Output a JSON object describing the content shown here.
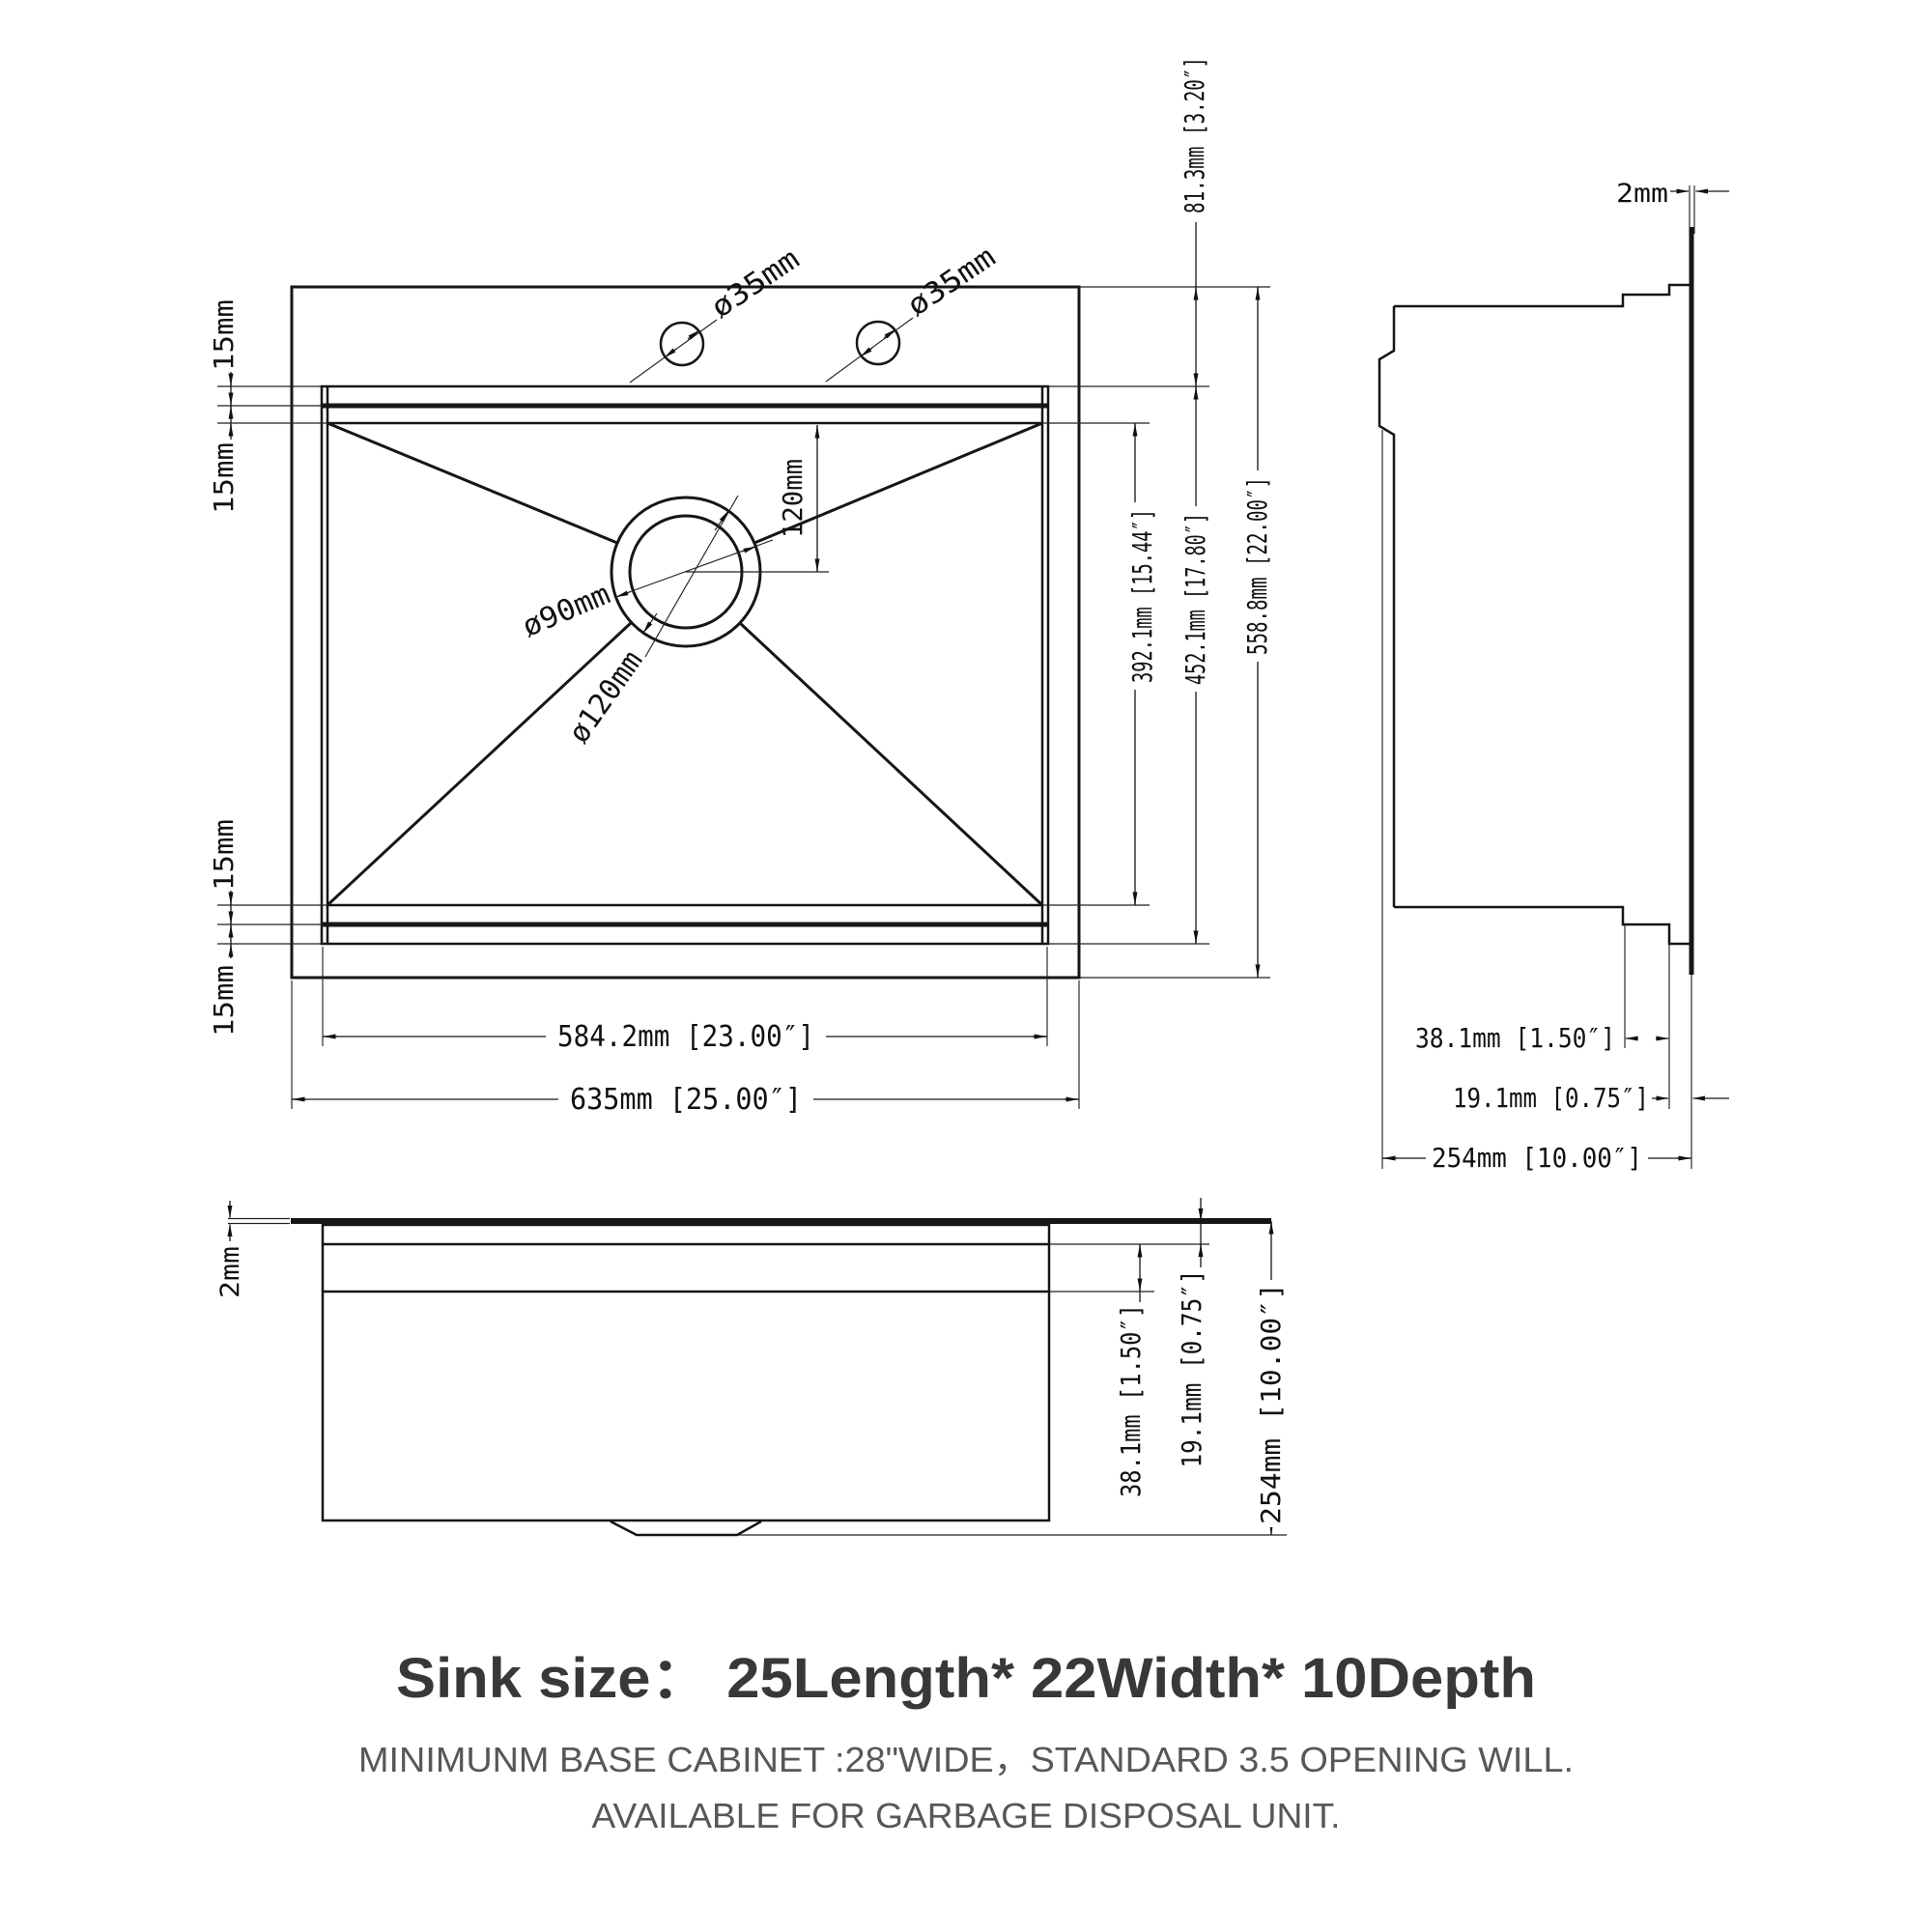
{
  "top_view": {
    "faucet_labels": [
      "ø35mm",
      "ø35mm"
    ],
    "drain_outer_label": "ø120mm",
    "drain_inner_label": "ø90mm",
    "drain_offset_dim": "120mm",
    "edge_dims": [
      "15mm",
      "15mm",
      "15mm",
      "15mm"
    ],
    "dim_81": "81.3mm [3.20″]",
    "dim_392": "392.1mm [15.44″]",
    "dim_452": "452.1mm [17.80″]",
    "dim_558": "558.8mm [22.00″]",
    "dim_584": "584.2mm [23.00″]",
    "dim_635": "635mm [25.00″]"
  },
  "side_view": {
    "dim_2": "2mm",
    "dim_38": "38.1mm [1.50″]",
    "dim_19": "19.1mm [0.75″]",
    "dim_254": "254mm [10.00″]"
  },
  "front_view": {
    "dim_2": "2mm",
    "dim_38": "38.1mm [1.50″]",
    "dim_19": "19.1mm [0.75″]",
    "dim_254": "254mm [10.00″]"
  },
  "footer": {
    "title": "Sink size：  25Length* 22Width* 10Depth",
    "note_line1": "MINIMUNM BASE CABINET :28\"WIDE，STANDARD 3.5 OPENING WILL.",
    "note_line2": "AVAILABLE FOR GARBAGE DISPOSAL UNIT."
  }
}
